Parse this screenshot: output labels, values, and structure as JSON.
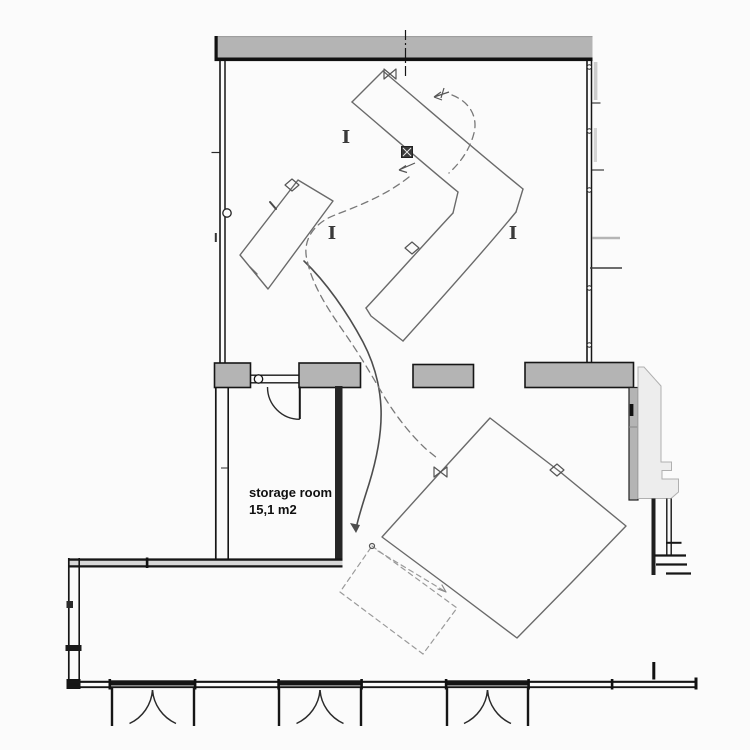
{
  "plan": {
    "rooms": [
      {
        "name": "storage room",
        "area": "15,1 m2"
      }
    ],
    "column_marker_glyph": "I"
  },
  "colors": {
    "paper": "#fbfbfb",
    "wall_gray": "#b4b4b4",
    "wall_dark": "#161616",
    "stair_light": "#ededed",
    "sketch_gray": "#6a6a6a",
    "pencil_dark": "#4d4d4d"
  }
}
